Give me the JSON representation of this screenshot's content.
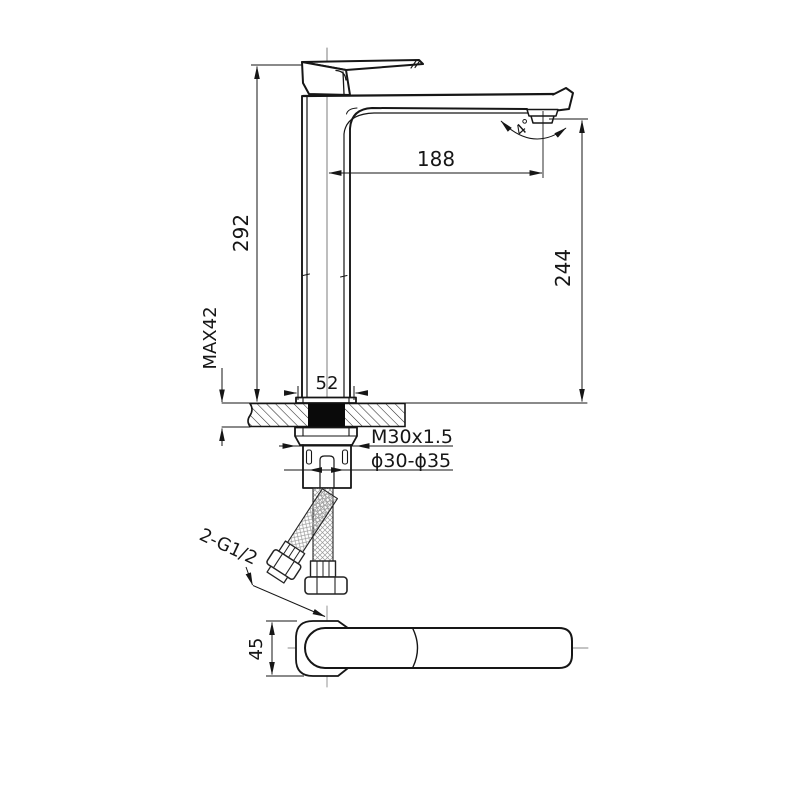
{
  "drawing": {
    "kind": "faucet-installation-dimension-diagram",
    "dimensions": {
      "overall_height": "292",
      "spout_reach": "188",
      "outlet_height": "244",
      "max_deck_thickness": "MAX42",
      "base_width": "52",
      "thread_spec": "M30x1.5",
      "hole_diameter": "ϕ30-ϕ35",
      "hose_connection": "2-G1/2",
      "top_view_width": "45",
      "outlet_angle": "4°"
    },
    "colors": {
      "line": "#161616",
      "centerline": "#8a8a8a",
      "background": "#ffffff",
      "section_fill": "#0a0a0a"
    }
  }
}
